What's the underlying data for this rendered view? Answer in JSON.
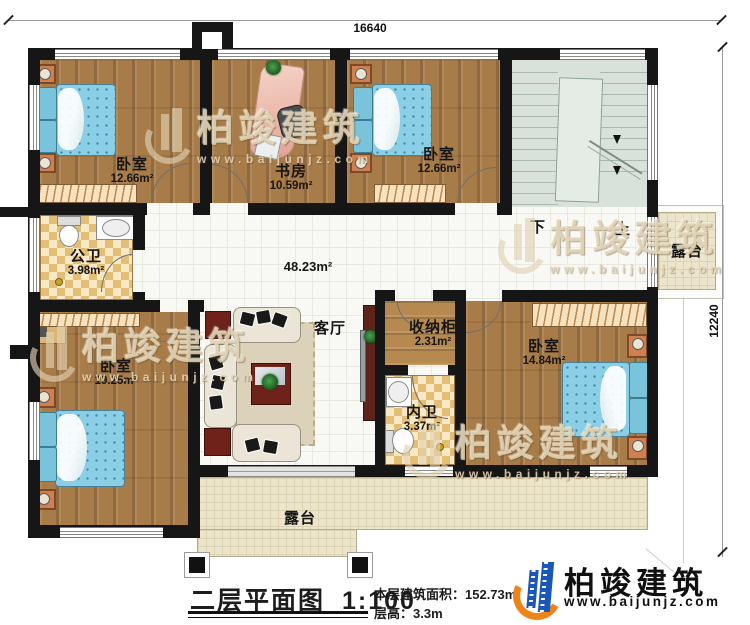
{
  "dimensions": {
    "width_label": "16640",
    "height_label": "12240"
  },
  "rooms": {
    "bedroom_tl": {
      "name": "卧室",
      "area": "12.66m²"
    },
    "study": {
      "name": "书房",
      "area": "10.59m²"
    },
    "bedroom_tr": {
      "name": "卧室",
      "area": "12.66m²"
    },
    "bath_public": {
      "name": "公卫",
      "area": "3.98m²"
    },
    "hall_area": {
      "area": "48.23m²"
    },
    "living": {
      "name": "客厅"
    },
    "storage": {
      "name": "收纳柜",
      "area": "2.31m²"
    },
    "bedroom_r": {
      "name": "卧室",
      "area": "14.84m²"
    },
    "bedroom_bl": {
      "name": "卧室",
      "area": "19.25m²"
    },
    "bath_ensuite": {
      "name": "内卫",
      "area": "3.37m²"
    },
    "terrace_right": {
      "name": "露台"
    },
    "terrace_bottom": {
      "name": "露台"
    }
  },
  "stairs": {
    "down": "下",
    "up": "上"
  },
  "titleblock": {
    "title": "二层平面图",
    "scale": "1:100",
    "area_line": "本层建筑面积：152.73m²",
    "height_line": "层高：3.3m"
  },
  "brand": {
    "name": "柏竣建筑",
    "url": "www.baijunjz.com"
  },
  "watermark": {
    "name": "柏竣建筑",
    "url": "www.baijunjz.com"
  }
}
